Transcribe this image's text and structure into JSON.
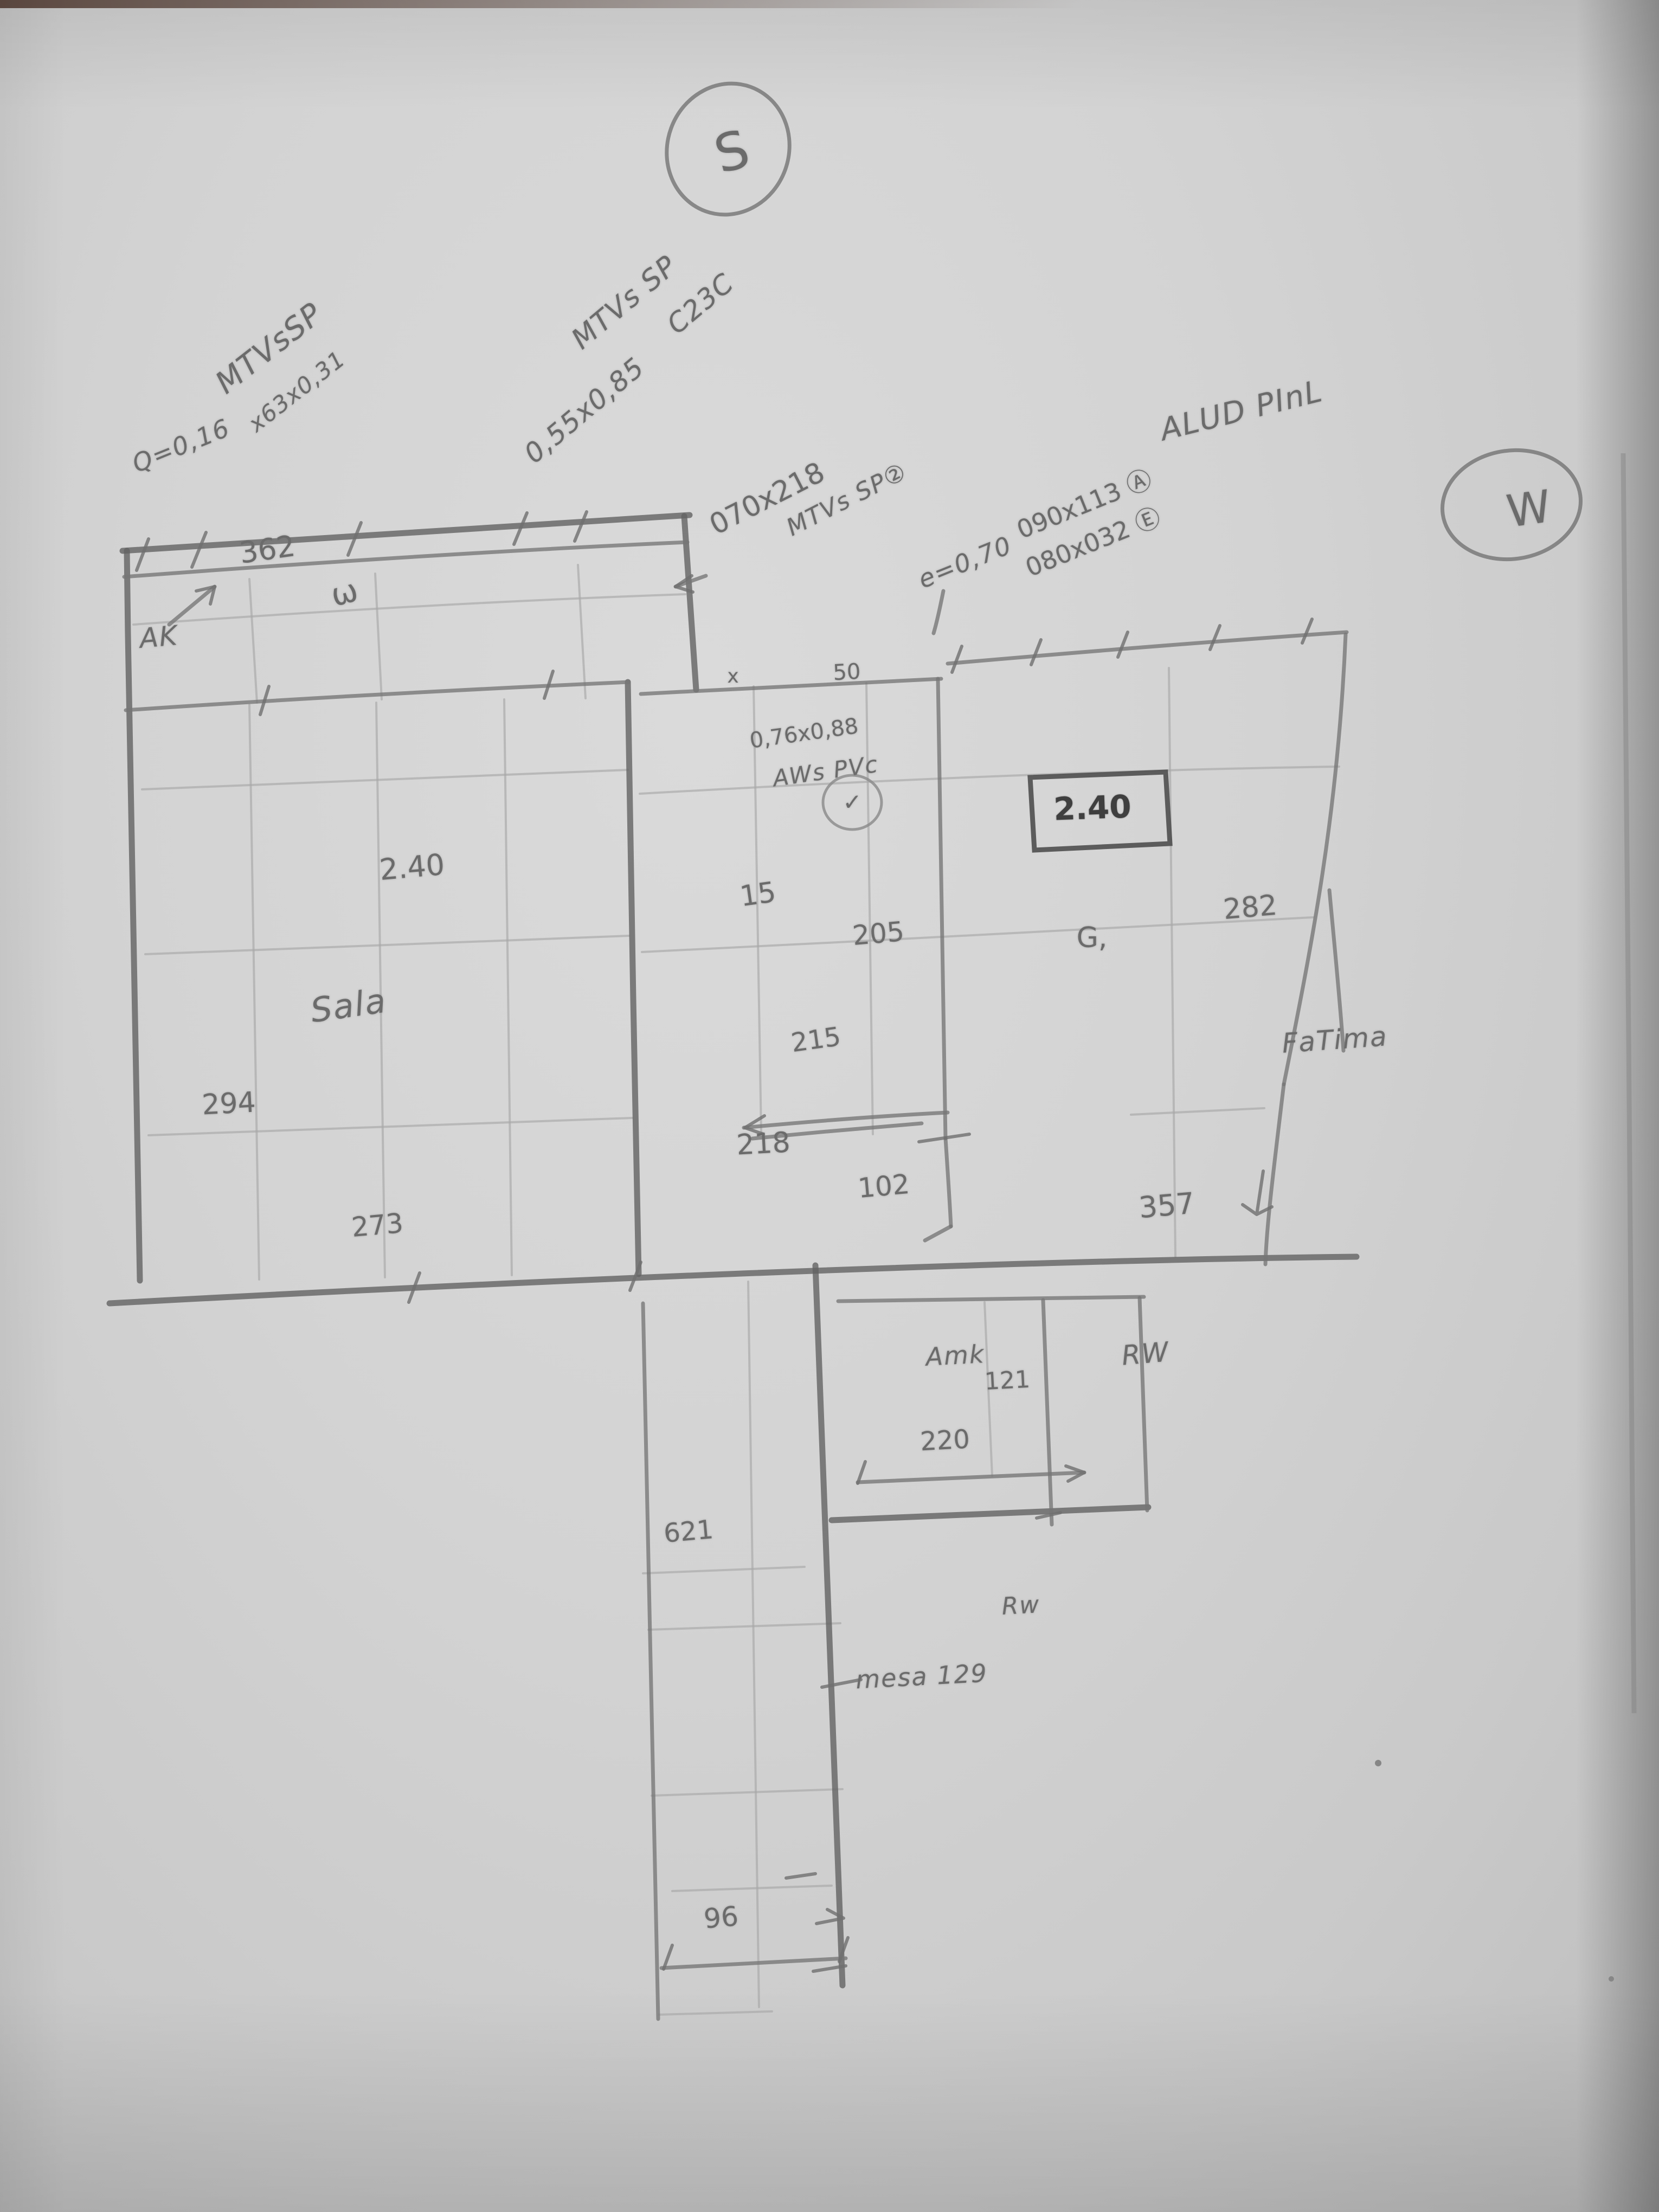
{
  "colors": {
    "paper": "#d3d3d3",
    "pencil_heavy": "#636363",
    "pencil_medium": "#767676",
    "pencil_faint": "#a8a8a8",
    "pencil_dark_text": "#3f3f3f"
  },
  "compass": {
    "south": "S",
    "west": "W"
  },
  "labels": {
    "mtv_sp_top_left": "MTVsSP",
    "q_value": "Q=0,16",
    "size_63": "x63x0,31",
    "dim_362": "362",
    "ak": "AK",
    "omega": "ω",
    "mtv_sp_top_mid": "MTVs SP",
    "size_055_085": "0,55x0,85",
    "c23c": "C23C",
    "size_070_218": "070x218",
    "mtv_sp_2": "MTVs SP②",
    "e_070": "e=0,70",
    "size_090_113": "090x113 Ⓐ",
    "size_080_032": "080x032 Ⓔ",
    "alud_pinl": "ALUD PInL",
    "size_076_088": "0,76x0,88",
    "aws_pvc": "AWs PVc",
    "check": "✓",
    "boxed_height": "2.40",
    "room_height": "2.40",
    "sala": "Sala",
    "dim_294": "294",
    "dim_15": "15",
    "dim_205": "205",
    "g_mark": "G,",
    "dim_282": "282",
    "fatima": "FaTima",
    "dim_215": "215",
    "dim_218": "218",
    "dim_102": "102",
    "dim_357": "357",
    "dim_273": "273",
    "amk": "Amk",
    "dim_121": "121",
    "dim_220": "220",
    "rw_upper": "RW",
    "dim_621": "621",
    "rw_lower": "Rw",
    "mesa_129": "mesa 129",
    "dim_96": "96",
    "x_mark": "x",
    "dim_50": "50"
  }
}
